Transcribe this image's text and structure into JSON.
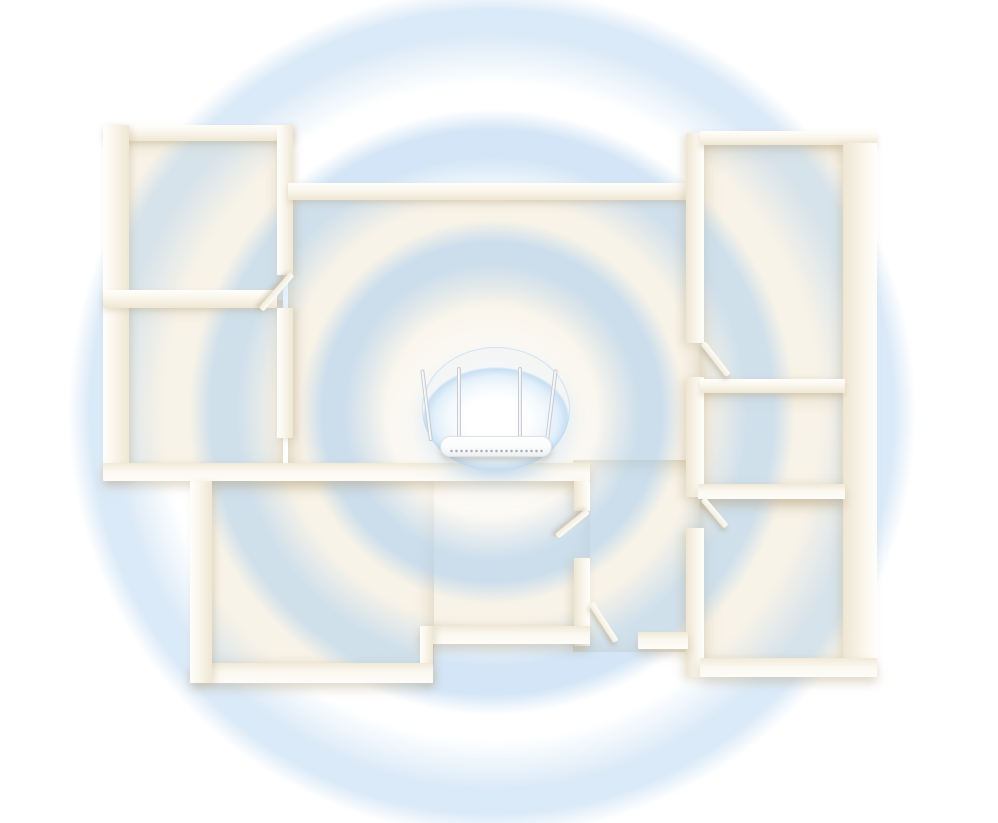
{
  "scene": {
    "canvas": {
      "w": 998,
      "h": 823,
      "background": "#ffffff"
    },
    "palette": {
      "floor": "#f8f3e8",
      "wall_top": "#fefefb",
      "wall_face": "#efe7d4",
      "ring_blue": "#d3e5f6",
      "bubble_rim": "#c5def3",
      "router_white": "#fafbfb",
      "vent_gray": "#9aa1ab"
    },
    "signal": {
      "center": {
        "x": 492,
        "y": 412
      },
      "ring_rgb": "175,208,238",
      "rings": [
        {
          "tail": 105,
          "peak_in": 148,
          "peak_out": 170,
          "outer": 192,
          "alpha": 0.6
        },
        {
          "tail": 212,
          "peak_in": 255,
          "peak_out": 282,
          "outer": 303,
          "alpha": 0.55
        },
        {
          "tail": 328,
          "peak_in": 378,
          "peak_out": 402,
          "outer": 424,
          "alpha": 0.45
        }
      ],
      "center_glow": {
        "x": 492,
        "y": 430,
        "inner": 60,
        "outer": 145,
        "alpha": 0.75
      }
    },
    "floors": [
      {
        "r": [
          108,
          135,
          175,
          170
        ]
      },
      {
        "r": [
          108,
          300,
          175,
          170
        ]
      },
      {
        "r": [
          288,
          190,
          412,
          282
        ]
      },
      {
        "r": [
          573,
          460,
          127,
          192
        ]
      },
      {
        "r": [
          198,
          478,
          392,
          152
        ]
      },
      {
        "r": [
          198,
          478,
          236,
          188
        ]
      },
      {
        "r": [
          700,
          143,
          162,
          242
        ]
      },
      {
        "r": [
          700,
          390,
          162,
          98
        ]
      },
      {
        "r": [
          700,
          497,
          162,
          166
        ]
      }
    ],
    "walls": [
      {
        "r": [
          103,
          125,
          190,
          16
        ],
        "t": "n"
      },
      {
        "r": [
          103,
          125,
          26,
          355
        ],
        "t": "w"
      },
      {
        "r": [
          277,
          125,
          16,
          150
        ],
        "t": "w"
      },
      {
        "r": [
          103,
          290,
          174,
          18
        ],
        "t": "n"
      },
      {
        "r": [
          277,
          308,
          16,
          130
        ],
        "t": "w"
      },
      {
        "r": [
          288,
          183,
          412,
          17
        ],
        "t": "n"
      },
      {
        "r": [
          103,
          463,
          487,
          18
        ],
        "t": "s"
      },
      {
        "r": [
          574,
          481,
          16,
          30
        ],
        "t": "e"
      },
      {
        "r": [
          574,
          558,
          16,
          88
        ],
        "t": "e"
      },
      {
        "r": [
          420,
          626,
          170,
          18
        ],
        "t": "s"
      },
      {
        "r": [
          420,
          626,
          13,
          57
        ],
        "t": "w"
      },
      {
        "r": [
          190,
          663,
          243,
          20
        ],
        "t": "s"
      },
      {
        "r": [
          190,
          481,
          22,
          202
        ],
        "t": "w"
      },
      {
        "r": [
          686,
          133,
          18,
          210
        ],
        "t": "e"
      },
      {
        "r": [
          686,
          377,
          18,
          120
        ],
        "t": "e"
      },
      {
        "r": [
          686,
          528,
          18,
          149
        ],
        "t": "e"
      },
      {
        "r": [
          700,
          131,
          177,
          14
        ],
        "t": "n"
      },
      {
        "r": [
          843,
          143,
          34,
          524
        ],
        "t": "e"
      },
      {
        "r": [
          700,
          379,
          145,
          14
        ],
        "t": "n"
      },
      {
        "r": [
          698,
          484,
          147,
          15
        ],
        "t": "s"
      },
      {
        "r": [
          700,
          658,
          177,
          19
        ],
        "t": "s"
      },
      {
        "r": [
          638,
          632,
          50,
          17
        ],
        "t": "s"
      }
    ],
    "doors": [
      {
        "x": 292,
        "y": 271,
        "len": 47,
        "ang": 131
      },
      {
        "x": 703,
        "y": 340,
        "len": 41,
        "ang": 52
      },
      {
        "x": 703,
        "y": 496,
        "len": 36,
        "ang": 50
      },
      {
        "x": 588,
        "y": 508,
        "len": 40,
        "ang": 141
      },
      {
        "x": 591,
        "y": 600,
        "len": 46,
        "ang": 57
      }
    ],
    "router": {
      "bubble": {
        "x": 422,
        "y": 347,
        "w": 148,
        "h": 124
      },
      "glow": {
        "x": 434,
        "y": 452,
        "w": 124,
        "h": 34
      },
      "body": {
        "x": 440,
        "y": 436,
        "w": 112,
        "h": 21
      },
      "vents": {
        "x": 449,
        "y": 448,
        "w": 95,
        "h": 6
      },
      "antennas": [
        {
          "x": 429,
          "y": 369,
          "h": 72,
          "rot": -7
        },
        {
          "x": 457,
          "y": 367,
          "h": 72,
          "rot": 0
        },
        {
          "x": 518,
          "y": 367,
          "h": 72,
          "rot": 0
        },
        {
          "x": 545,
          "y": 369,
          "h": 72,
          "rot": 7
        }
      ]
    }
  }
}
